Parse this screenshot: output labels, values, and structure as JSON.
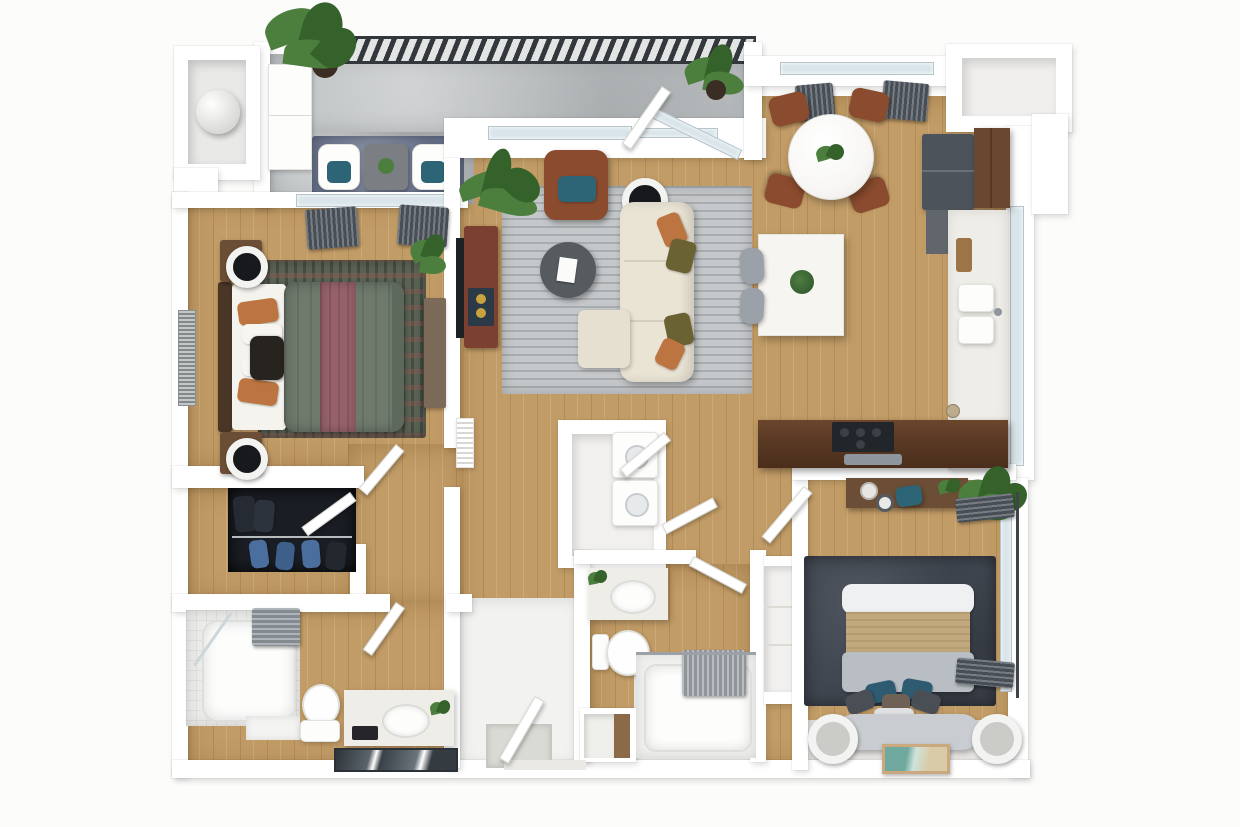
{
  "scene": {
    "title": "Top-down 3D apartment floor plan render",
    "type": "floor-plan-3d-render"
  },
  "palette": {
    "wall": "#ffffff",
    "wood": "#c29c66",
    "glass": "#d9e5ea",
    "tile": "#f2f2f0",
    "concrete": "#b9bdbf",
    "railing": "#33383d",
    "curtain": "#545b63",
    "rugLiving": "#c5c8ca",
    "rugMaster": "#5a6355",
    "rugBalcony": "#667089",
    "rugBed2": "#404650",
    "sofa": "#eae4d5",
    "armchair": "#8a4b2e",
    "orange": "#bc7540",
    "teal": "#2e6576",
    "bedSage": "#6f7a6d",
    "bedMauve": "#96616b",
    "bed2Gray": "#b8bec4",
    "bed2Tan": "#c2a87c",
    "bed2Head": "#c9cdd1",
    "walnut": "#5a3a24",
    "woodFurn": "#6b4e35",
    "consoleBrown": "#7b4030",
    "cabinetBrown": "#6a4731",
    "fridge": "#4d535a",
    "steel": "#8e959d",
    "counter": "#efede8",
    "island": "#f6f5f1",
    "marble": "#f8f7f5",
    "stool": "#9aa1a8",
    "plant": "#4c7f3e",
    "plantDark": "#35622a",
    "closetDark": "#1a1e24",
    "jeans": "#4a6f9e",
    "mirror": "#394147",
    "artTeal": "#6fa89e",
    "tvBlack": "#1d2126",
    "speaker": "#2c3947",
    "pot": "#3a2e24"
  },
  "rooms": [
    {
      "id": "balcony",
      "label": "Balcony",
      "floor": "concrete",
      "furniture": [
        "railing",
        "lounge-chair",
        "lounge-chair",
        "side-table",
        "outdoor-rug",
        "storage-cabinet",
        "potted-plant"
      ]
    },
    {
      "id": "utility-closet",
      "label": "Utility Closet",
      "floor": "painted",
      "furniture": [
        "water-heater"
      ]
    },
    {
      "id": "primary-bedroom",
      "label": "Primary Bedroom",
      "floor": "wood",
      "furniture": [
        "queen-bed",
        "sage-comforter",
        "mauve-runner",
        "nightstand",
        "nightstand",
        "round-lamp",
        "round-lamp",
        "area-rug",
        "dresser",
        "wall-art",
        "window-curtains",
        "plant"
      ]
    },
    {
      "id": "walk-in-closet",
      "label": "Walk-in Closet",
      "floor": "wood",
      "furniture": [
        "hanging-clothes",
        "clothes-rod"
      ]
    },
    {
      "id": "primary-bathroom",
      "label": "Primary Bathroom",
      "floor": "wood",
      "furniture": [
        "tub-shower",
        "shower-curtain",
        "toilet",
        "vanity-sink",
        "leaning-mirror",
        "plant"
      ]
    },
    {
      "id": "living-room",
      "label": "Living Room",
      "floor": "wood",
      "furniture": [
        "sectional-sofa",
        "chaise",
        "round-coffee-table",
        "area-rug",
        "leather-armchair",
        "floor-lamp",
        "tv-console",
        "wall-tv",
        "speaker",
        "palm-plant",
        "window-curtains",
        "sliding-glass-door"
      ]
    },
    {
      "id": "dining-area",
      "label": "Dining Area",
      "floor": "wood",
      "furniture": [
        "round-marble-table",
        "dining-chair",
        "dining-chair",
        "dining-chair",
        "dining-chair",
        "centerpiece-plant",
        "window-curtains",
        "kitchen-island",
        "bar-stool",
        "bar-stool"
      ]
    },
    {
      "id": "kitchen",
      "label": "Kitchen",
      "floor": "wood",
      "furniture": [
        "refrigerator",
        "upper-cabinets",
        "counter",
        "double-sink",
        "cutting-board",
        "jars",
        "walnut-bar-counter",
        "range-cooktop",
        "tray"
      ]
    },
    {
      "id": "entry-hallway",
      "label": "Entry / Hallway",
      "floor": "tile",
      "furniture": [
        "front-door",
        "doormat",
        "coat-niche"
      ]
    },
    {
      "id": "laundry-closet",
      "label": "Laundry Closet",
      "floor": "tile",
      "furniture": [
        "stacked-washer",
        "stacked-dryer",
        "bifold-doors"
      ]
    },
    {
      "id": "bathroom-2",
      "label": "Bathroom 2",
      "floor": "wood-and-tile",
      "furniture": [
        "vanity-sink",
        "toilet",
        "bathtub",
        "shower-curtain",
        "plant"
      ]
    },
    {
      "id": "bedroom-2",
      "label": "Bedroom 2",
      "floor": "wood",
      "furniture": [
        "bed",
        "upholstered-headboard",
        "side-lamp",
        "side-lamp",
        "charcoal-rug",
        "desk",
        "desk-chair",
        "desk-lamp",
        "plant",
        "large-plant",
        "window-curtains",
        "leaning-art"
      ]
    },
    {
      "id": "storage-nook",
      "label": "Storage Nook",
      "floor": "painted",
      "furniture": []
    }
  ]
}
